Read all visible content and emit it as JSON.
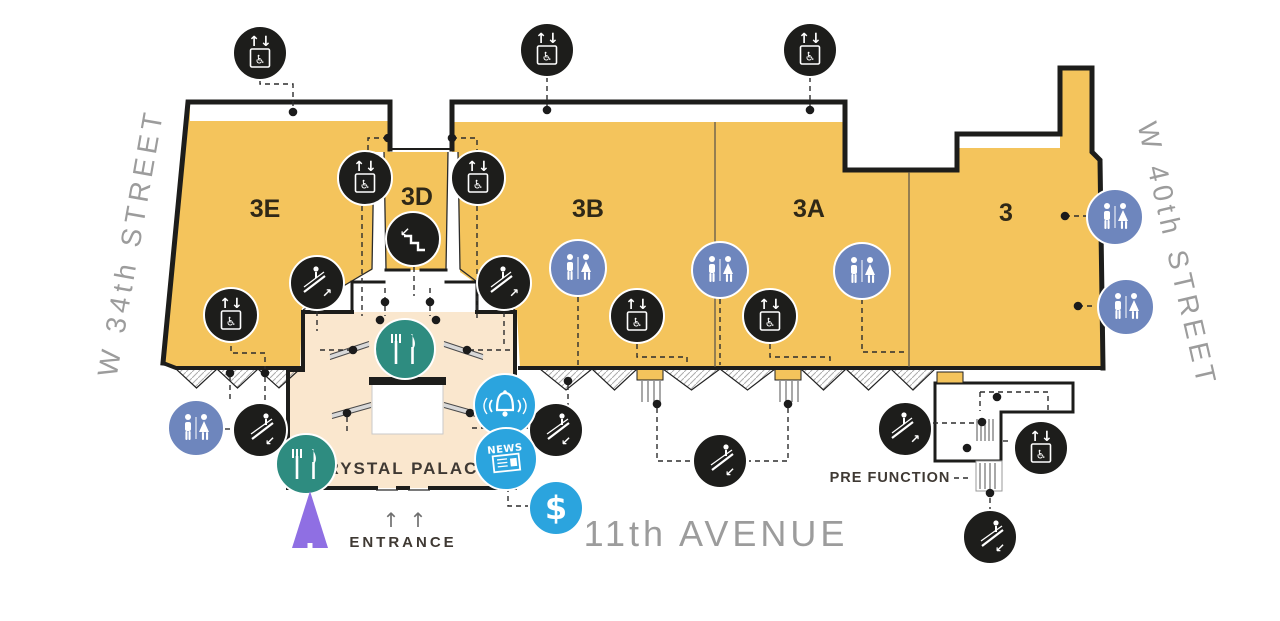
{
  "map": {
    "streets": {
      "left": "W 34th STREET",
      "right": "W 40th STREET",
      "bottom": "11th AVENUE"
    },
    "halls": {
      "h3e": "3E",
      "h3d": "3D",
      "h3b": "3B",
      "h3a": "3A",
      "h3": "3"
    },
    "areas": {
      "crystal_palace": "CRYSTAL PALACE",
      "pre_function": "PRE FUNCTION",
      "entrance": "ENTRANCE"
    },
    "glyphs": {
      "elevator_arrows": "↑↓",
      "wheelchair": "♿",
      "arrow_up_right": "↗",
      "arrow_down_left": "↙",
      "news_label": "NEWS",
      "dollar": "$",
      "entrance_arrow": "↑"
    },
    "colors": {
      "hall_fill": "#F4C45C",
      "concourse_fill": "#FAE7CE",
      "wall": "#1D1D1B",
      "icon_black": "#1D1D1B",
      "restroom_blue": "#6E86BD",
      "restaurant_teal": "#2E8C80",
      "info_blue": "#2BA4DE",
      "street_text": "#9C9C9C",
      "marker_purple": "#8F6FE3"
    },
    "icons": [
      {
        "type": "elevator",
        "name": "elevator-icon",
        "x": 260,
        "y": 53
      },
      {
        "type": "elevator",
        "name": "elevator-icon",
        "x": 547,
        "y": 50
      },
      {
        "type": "elevator",
        "name": "elevator-icon",
        "x": 810,
        "y": 50
      },
      {
        "type": "elevator",
        "name": "elevator-icon",
        "x": 365,
        "y": 178
      },
      {
        "type": "elevator",
        "name": "elevator-icon",
        "x": 478,
        "y": 178
      },
      {
        "type": "elevator",
        "name": "elevator-icon",
        "x": 231,
        "y": 315
      },
      {
        "type": "elevator",
        "name": "elevator-icon",
        "x": 637,
        "y": 316
      },
      {
        "type": "elevator",
        "name": "elevator-icon",
        "x": 770,
        "y": 316
      },
      {
        "type": "elevator",
        "name": "elevator-icon",
        "x": 1041,
        "y": 448
      },
      {
        "type": "stairs",
        "name": "stairs-icon",
        "x": 413,
        "y": 239
      },
      {
        "type": "escalator-up",
        "name": "escalator-up-icon",
        "x": 317,
        "y": 283
      },
      {
        "type": "escalator-up",
        "name": "escalator-up-icon",
        "x": 504,
        "y": 283
      },
      {
        "type": "escalator-up",
        "name": "escalator-up-icon",
        "x": 905,
        "y": 429
      },
      {
        "type": "escalator-down",
        "name": "escalator-down-icon",
        "x": 260,
        "y": 430
      },
      {
        "type": "escalator-down",
        "name": "escalator-down-icon",
        "x": 556,
        "y": 430
      },
      {
        "type": "escalator-down",
        "name": "escalator-down-icon",
        "x": 720,
        "y": 461
      },
      {
        "type": "escalator-down",
        "name": "escalator-down-icon",
        "x": 990,
        "y": 537
      },
      {
        "type": "restroom",
        "name": "restroom-icon",
        "x": 578,
        "y": 268
      },
      {
        "type": "restroom",
        "name": "restroom-icon",
        "x": 720,
        "y": 270
      },
      {
        "type": "restroom",
        "name": "restroom-icon",
        "x": 862,
        "y": 271
      },
      {
        "type": "restroom",
        "name": "restroom-icon",
        "x": 1115,
        "y": 217
      },
      {
        "type": "restroom",
        "name": "restroom-icon",
        "x": 1126,
        "y": 307
      },
      {
        "type": "restroom",
        "name": "restroom-icon",
        "x": 196,
        "y": 428
      },
      {
        "type": "restaurant",
        "name": "restaurant-icon",
        "x": 405,
        "y": 349
      },
      {
        "type": "restaurant",
        "name": "restaurant-icon",
        "x": 306,
        "y": 464
      },
      {
        "type": "bell",
        "name": "bell-icon",
        "x": 505,
        "y": 405
      },
      {
        "type": "news",
        "name": "newsstand-icon",
        "x": 506,
        "y": 459
      },
      {
        "type": "dollar",
        "name": "atm-icon",
        "x": 556,
        "y": 508
      },
      {
        "type": "marker",
        "name": "location-marker-icon",
        "x": 310,
        "y": 520
      }
    ]
  }
}
